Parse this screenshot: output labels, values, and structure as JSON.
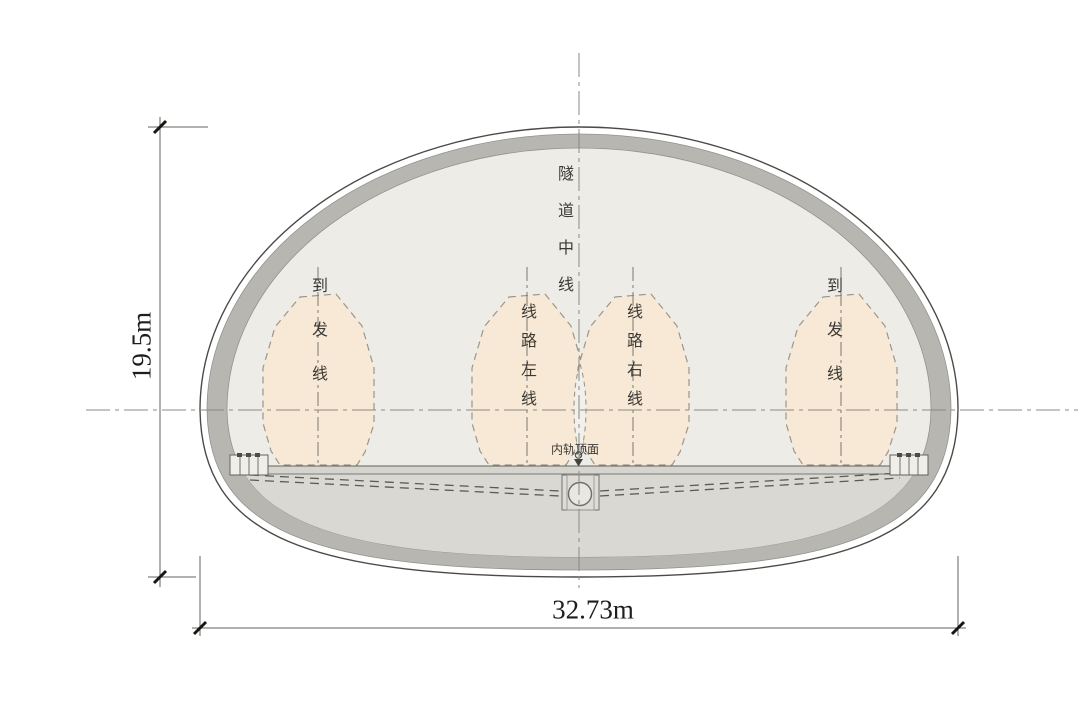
{
  "diagram": {
    "type": "railway tunnel cross-section",
    "center_label": "隧道中线",
    "rail_top_label": "内轨顶面",
    "tracks": [
      {
        "id": "arrival-departure-left",
        "label": "到发线"
      },
      {
        "id": "main-line-left",
        "label": "线路左线"
      },
      {
        "id": "main-line-right",
        "label": "线路右线"
      },
      {
        "id": "arrival-departure-right",
        "label": "到发线"
      }
    ],
    "dimensions": {
      "height": "19.5m",
      "width": "32.73m"
    },
    "colors": {
      "lining_gray": "#b7b6b1",
      "inner_fill": "#eeece7",
      "envelope_fill": "#f7e9d5",
      "slab_fill": "#d5d4cf",
      "invert_fill": "#d9d8d3",
      "channel_fill": "#f2f0eb",
      "outline": "#4a4a46"
    }
  }
}
